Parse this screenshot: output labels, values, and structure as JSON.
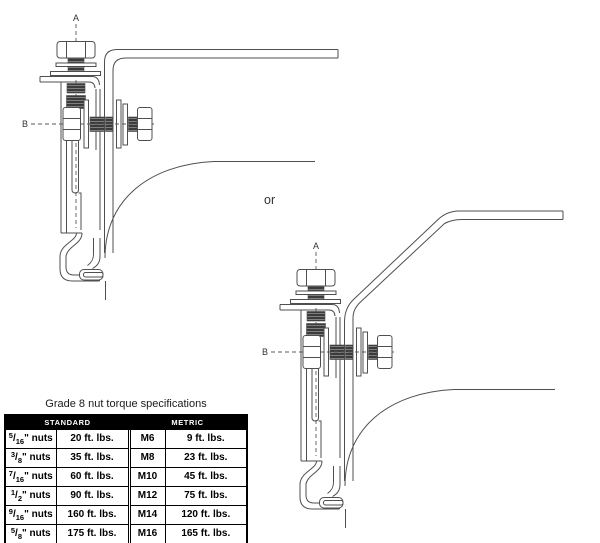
{
  "diagrams": {
    "label_a": "A",
    "label_b": "B",
    "or_text": "or",
    "line_color": "#4f4f4f",
    "thread_fill": "#3b3b3b"
  },
  "torque_table": {
    "title": "Grade 8 nut torque specifications",
    "fraction_separator": "/",
    "header_bg": "#000000",
    "header_text_color": "#ffffff",
    "headers": {
      "standard": "STANDARD",
      "metric": "METRIC"
    },
    "rows": [
      {
        "std_num": "5",
        "std_den": "16",
        "std_suffix": "\" nuts",
        "std_torque": "20 ft. lbs.",
        "metric_size": "M6",
        "metric_torque": "9 ft. lbs."
      },
      {
        "std_num": "3",
        "std_den": "8",
        "std_suffix": "\" nuts",
        "std_torque": "35 ft. lbs.",
        "metric_size": "M8",
        "metric_torque": "23 ft. lbs."
      },
      {
        "std_num": "7",
        "std_den": "16",
        "std_suffix": "\" nuts",
        "std_torque": "60 ft. lbs.",
        "metric_size": "M10",
        "metric_torque": "45 ft. lbs."
      },
      {
        "std_num": "1",
        "std_den": "2",
        "std_suffix": "\" nuts",
        "std_torque": "90 ft. lbs.",
        "metric_size": "M12",
        "metric_torque": "75 ft. lbs."
      },
      {
        "std_num": "9",
        "std_den": "16",
        "std_suffix": "\" nuts",
        "std_torque": "160 ft. lbs.",
        "metric_size": "M14",
        "metric_torque": "120 ft. lbs."
      },
      {
        "std_num": "5",
        "std_den": "8",
        "std_suffix": "\" nuts",
        "std_torque": "175 ft. lbs.",
        "metric_size": "M16",
        "metric_torque": "165 ft. lbs."
      }
    ]
  }
}
